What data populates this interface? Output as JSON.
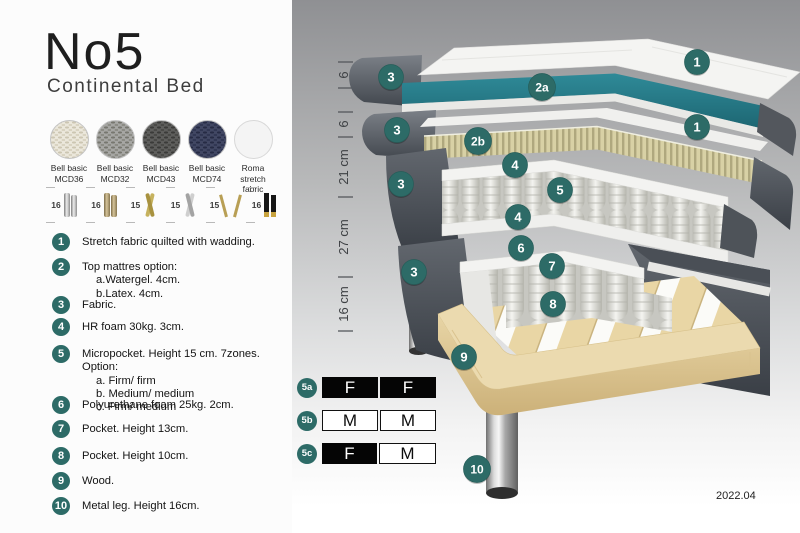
{
  "header": {
    "title": "No5",
    "subtitle": "Continental Bed"
  },
  "fabrics": [
    {
      "line1": "Bell basic",
      "line2": "MCD36"
    },
    {
      "line1": "Bell basic",
      "line2": "MCD32"
    },
    {
      "line1": "Bell basic",
      "line2": "MCD43"
    },
    {
      "line1": "Bell basic",
      "line2": "MCD74"
    },
    {
      "line1": "Roma",
      "line2": "stretch fabric"
    }
  ],
  "legs": [
    {
      "height": "16",
      "type": "cylinder-silver"
    },
    {
      "height": "16",
      "type": "cylinder-bronze"
    },
    {
      "height": "15",
      "type": "twisted-gold"
    },
    {
      "height": "15",
      "type": "twisted-silver"
    },
    {
      "height": "15",
      "type": "hairpin-gold"
    },
    {
      "height": "16",
      "type": "black-gold"
    }
  ],
  "features": [
    {
      "num": "1",
      "text": "Stretch fabric quilted with wadding."
    },
    {
      "num": "2",
      "text": "Top mattres option:",
      "subs": [
        "a.Watergel. 4cm.",
        "b.Latex. 4cm."
      ]
    },
    {
      "num": "3",
      "text": "Fabric."
    },
    {
      "num": "4",
      "text": "HR foam 30kg. 3cm."
    },
    {
      "num": "5",
      "text": "Micropocket. Height 15 cm. 7zones. Option:",
      "subs": [
        "a. Firm/ firm",
        "b. Medium/ medium",
        "c. Firm/ medium"
      ]
    },
    {
      "num": "6",
      "text": "Polyurethane foam 25kg. 2cm."
    },
    {
      "num": "7",
      "text": "Pocket. Height 13cm."
    },
    {
      "num": "8",
      "text": "Pocket. Height 10cm."
    },
    {
      "num": "9",
      "text": "Wood."
    },
    {
      "num": "10",
      "text": "Metal leg. Height 16cm."
    }
  ],
  "diagram": {
    "dimensions": [
      "6",
      "6",
      "21 cm",
      "27 cm",
      "16 cm"
    ],
    "callouts": {
      "c1": "1",
      "c2a": "2a",
      "c2b": "2b",
      "c3": "3",
      "c4": "4",
      "c5": "5",
      "c6": "6",
      "c7": "7",
      "c8": "8",
      "c9": "9",
      "c10": "10"
    },
    "version": "2022.04"
  },
  "firmness_table": {
    "rows": [
      {
        "id": "5a",
        "cells": [
          {
            "label": "F",
            "variant": "dark"
          },
          {
            "label": "F",
            "variant": "dark"
          }
        ]
      },
      {
        "id": "5b",
        "cells": [
          {
            "label": "M",
            "variant": "light"
          },
          {
            "label": "M",
            "variant": "light"
          }
        ]
      },
      {
        "id": "5c",
        "cells": [
          {
            "label": "F",
            "variant": "dark"
          },
          {
            "label": "M",
            "variant": "light"
          }
        ]
      }
    ]
  },
  "colors": {
    "accent_teal": "#2d6b67",
    "layer_teal": "#2a7f8d",
    "fabric_gray": "#565b62",
    "latex_tan": "#d8d2a8",
    "wood": "#e9d8ae"
  }
}
